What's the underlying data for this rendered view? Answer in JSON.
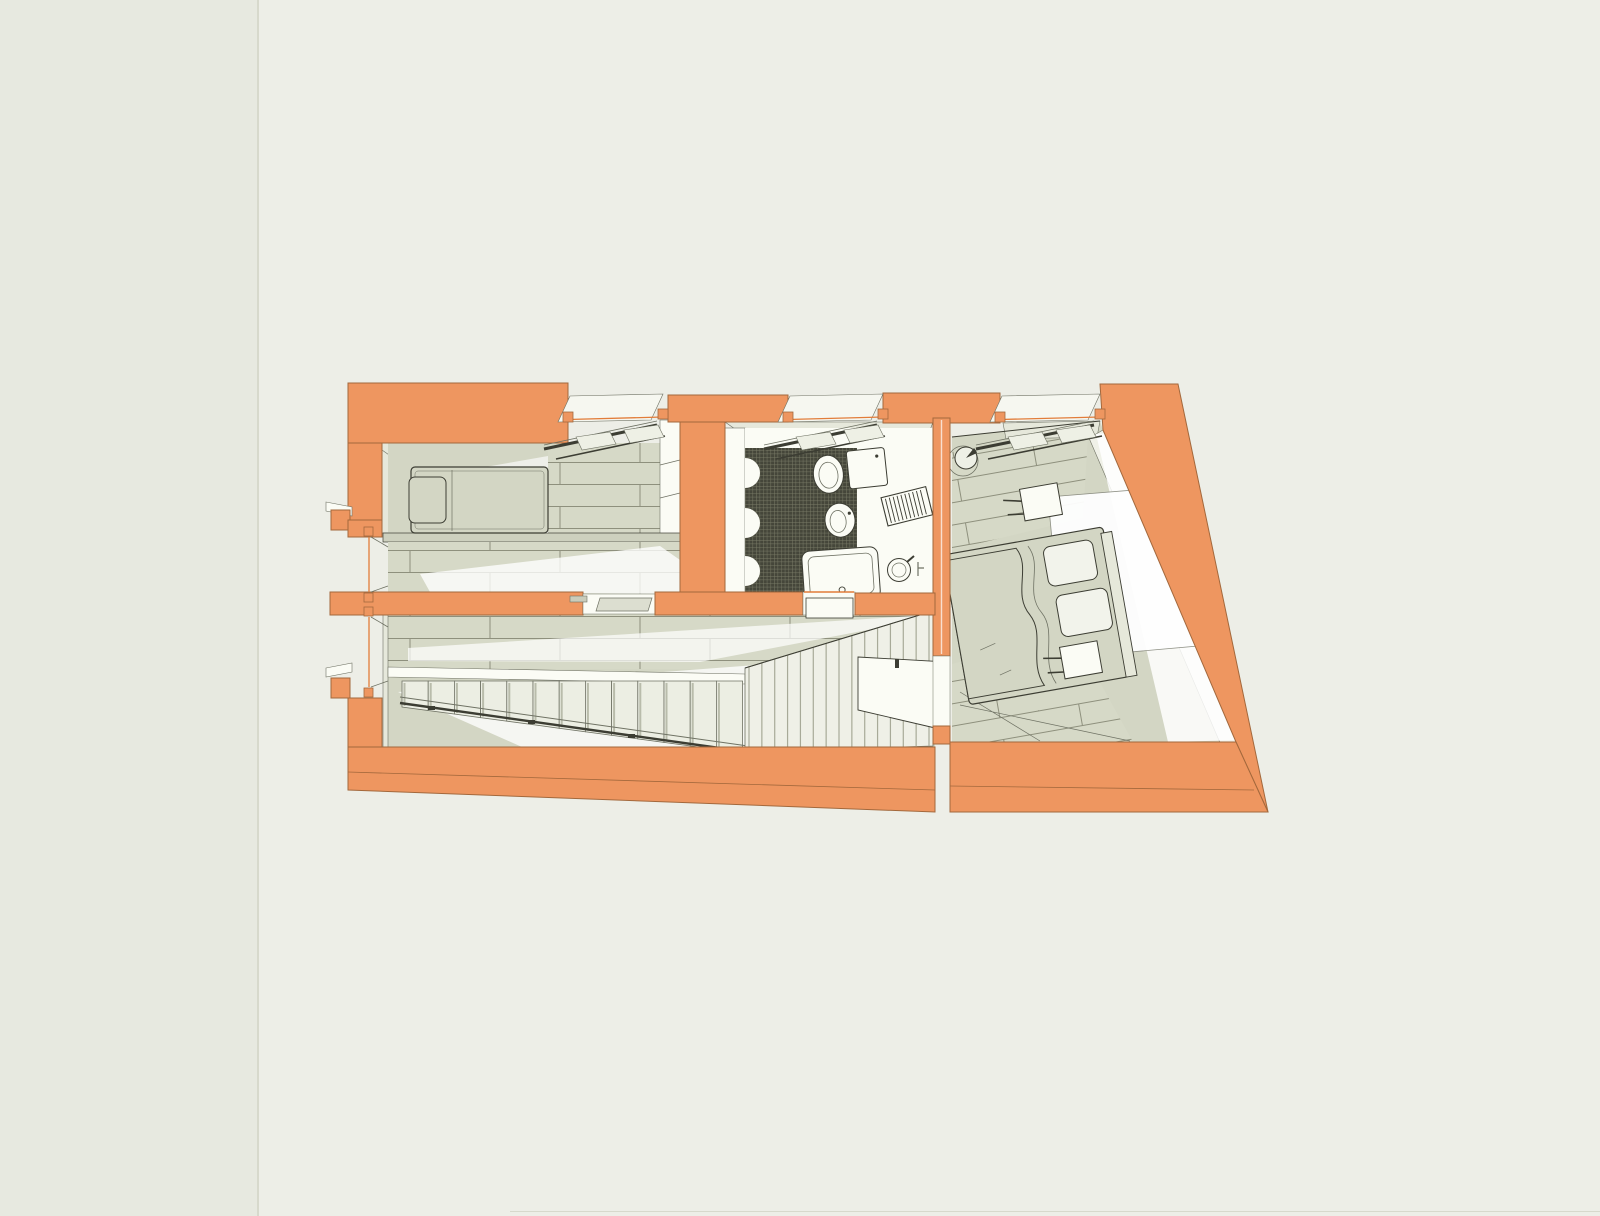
{
  "page": {
    "kind": "architectural-drawing-sheet",
    "divider_x": 258,
    "bottom_edge": {
      "x": 510,
      "y": 1211
    }
  },
  "drawing": {
    "title": "axonometric apartment floor plan",
    "projection": "cutaway axonometric",
    "colors": {
      "page_bg": "#e7e9e0",
      "panel_bg": "#edeee7",
      "page_edge": "#d7d9cc",
      "wall_cut": "#ee9660",
      "wall_edge": "#a3683c",
      "accent_line": "#e27d3a",
      "floor": "#d3d6c4",
      "floor_light": "#e6e8db",
      "plank_line": "#8e907d",
      "white_surface": "#fbfcf5",
      "outline_dark": "#3c3d33",
      "outline_mid": "#6f7264",
      "tile_dark": "#45463a",
      "tile_line": "#7b7d68"
    },
    "rooms": [
      {
        "name": "bedroom-small",
        "features": [
          "single-bed",
          "pillow",
          "wood-plank-floor",
          "skylight-window"
        ]
      },
      {
        "name": "bathroom",
        "features": [
          "toilet",
          "cistern",
          "bidet",
          "towel-radiator",
          "bathtub",
          "washbasin",
          "mosaic-tile-floor",
          "sliding-door",
          "skylight-window"
        ]
      },
      {
        "name": "bedroom-master",
        "features": [
          "double-bed",
          "duvet",
          "pillows",
          "nightstand-left",
          "nightstand-right",
          "round-side-table",
          "swing-door",
          "wood-plank-floor",
          "skylight-window"
        ]
      },
      {
        "name": "hallway",
        "features": [
          "wood-plank-floor",
          "pocket-sliding-door",
          "window-bays"
        ]
      },
      {
        "name": "stair-hall",
        "features": [
          "staircase",
          "handrail",
          "slatted-balustrade",
          "landing-edge"
        ]
      }
    ]
  },
  "generated": {
    "stairs": {
      "count": 13,
      "x0": 402,
      "step_w": 26.2,
      "top_y": 681,
      "bottom_y_start": 707,
      "bottom_y_end": 753
    },
    "balustrade": {
      "count": 15,
      "x0": 749,
      "x1": 929,
      "top_y0": 667,
      "top_y1": 612,
      "bot_y0": 751,
      "bot_y1": 746
    },
    "skylight_bays": [
      {
        "x1": 568,
        "x2": 663
      },
      {
        "x1": 788,
        "x2": 883
      },
      {
        "x1": 1000,
        "x2": 1100
      }
    ],
    "wall_bays": [
      {
        "y1": 537,
        "y2": 592
      },
      {
        "y1": 617,
        "y2": 687
      }
    ]
  }
}
